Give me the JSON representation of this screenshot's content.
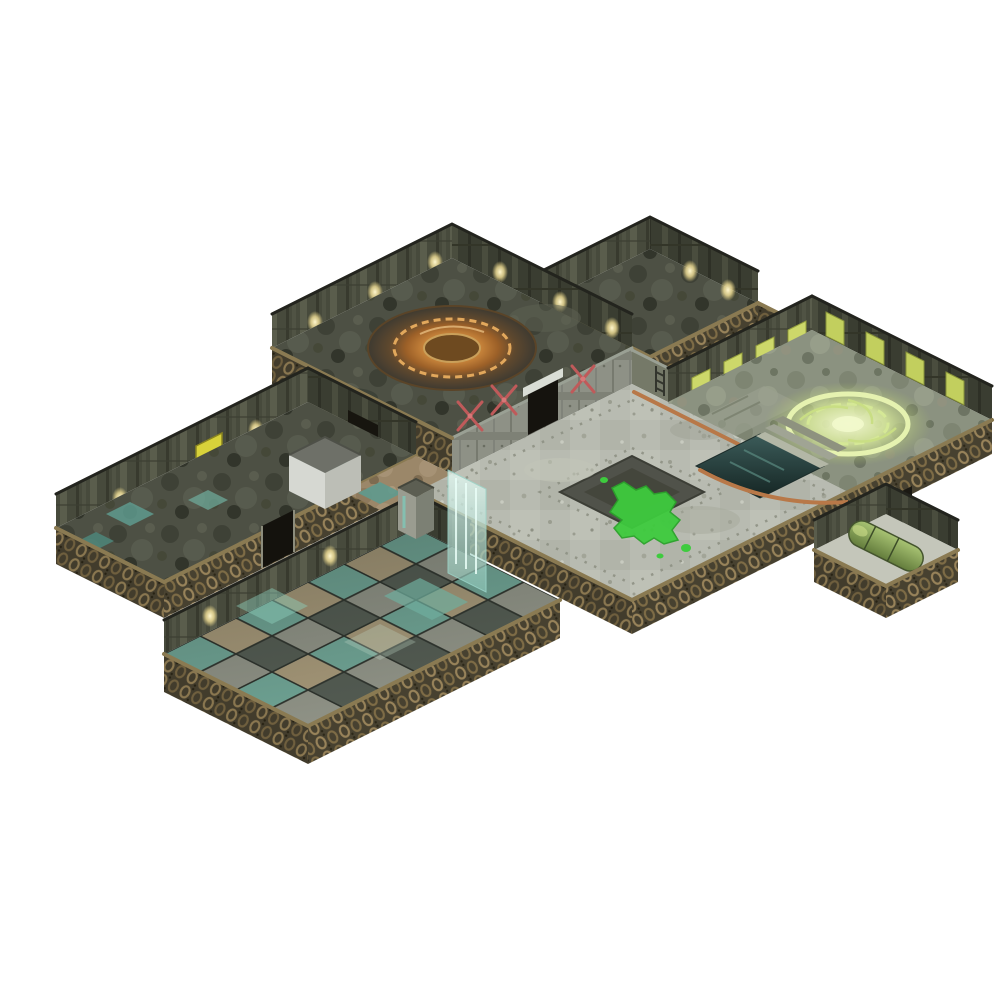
{
  "meta": {
    "description": "Isometric product photograph of a modular sci-fi tabletop dungeon terrain set, assembled into interconnected rooms and corridors, on a plain white background",
    "background": "#ffffff"
  },
  "palette": {
    "bg": "#ffffff",
    "wallDark": "#3a3d31",
    "wallMid": "#474a3c",
    "wallMetal": "#8e9186",
    "chainBronze": "#98835a",
    "chainBase": "#474130",
    "floorGrime": "#4d5044",
    "plazaStone": "#b8bbb1",
    "checkerTeal": "#6fa394",
    "checkerTan": "#a59778",
    "slimeGreen": "#3ecb3e",
    "hatchOrange": "#cf8a3e",
    "runeGreen": "#d9ea9c",
    "pipeRed": "#bf5a5a",
    "pipeCopper": "#b87848",
    "poolTeal": "#3c5c5a",
    "capsuleGreen": "#7e9a4e",
    "glassTeal": "#bfeee4",
    "lampYellow": "#fff6c8",
    "panelYellow": "#d8d23a",
    "screenYellowGreen": "#cdd86a"
  },
  "scene": {
    "regions": [
      {
        "name": "machine-room",
        "feature": "raised dark room with large orange circular hatch, pillar walls with lamps, front wall with doorway and red crossed pipes"
      },
      {
        "name": "upper-annex-room",
        "feature": "small dark-floored room behind the machine room, chain-textured outer walls"
      },
      {
        "name": "west-corridor",
        "feature": "long corridor wing with yellow wall panel, teal floor patches and front door arch"
      },
      {
        "name": "junction-yard",
        "feature": "tan stone junction with teal tiles and a small grey crate structure"
      },
      {
        "name": "central-plaza",
        "feature": "large light grey riveted stone plaza with dark inset square and bright green slime splat, grey statue near north entrance, copper pipe along wall"
      },
      {
        "name": "rune-room",
        "feature": "room with glowing pale-green circular rune, yellow-green wall screens, steps down to a dark teal pool"
      },
      {
        "name": "east-alcove",
        "feature": "small alcove containing a fallen green capsule tank"
      },
      {
        "name": "checker-hall",
        "feature": "large open hall with teal/grey/tan checkered tile floor, chain-link outer walls and corner door pillar"
      },
      {
        "name": "waterfall-panel",
        "feature": "translucent teal vertical water/glass panel spilling toward the checker hall"
      }
    ]
  }
}
